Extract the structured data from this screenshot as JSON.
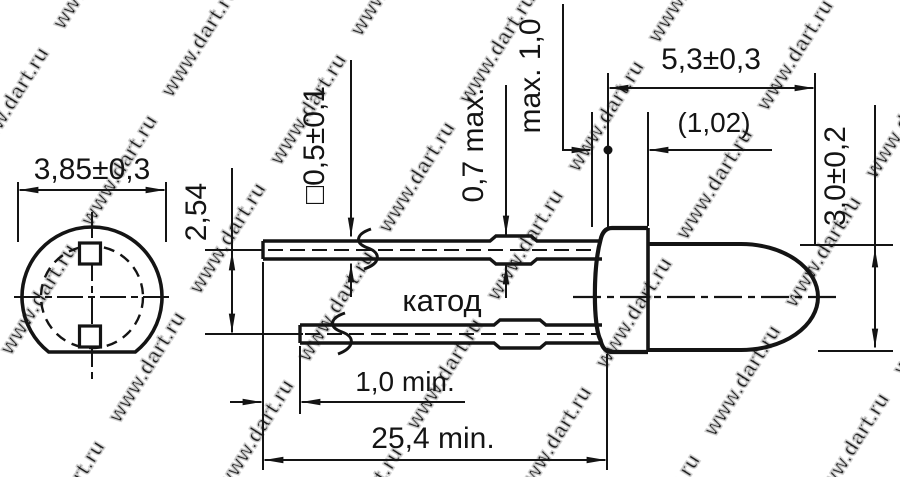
{
  "watermark": {
    "text": "www.dart.ru"
  },
  "colors": {
    "line": "#141414",
    "background": "#ffffff",
    "watermark_outline": "#cccccc"
  },
  "front_view": {
    "flange_diameter": "3,85±0,3"
  },
  "side_view": {
    "lead_pitch": "2,54",
    "lead_cross_section": "□0,5±0,1",
    "standoff_max": "0,7 max.",
    "meniscus_max": "max. 1,0",
    "body_length": "5,3±0,3",
    "flange_thickness": "(1,02)",
    "dome_diameter": "3,0±0,2",
    "cathode_label": "катод",
    "lead_min_offset": "1,0 min.",
    "lead_min_length": "25,4 min."
  }
}
